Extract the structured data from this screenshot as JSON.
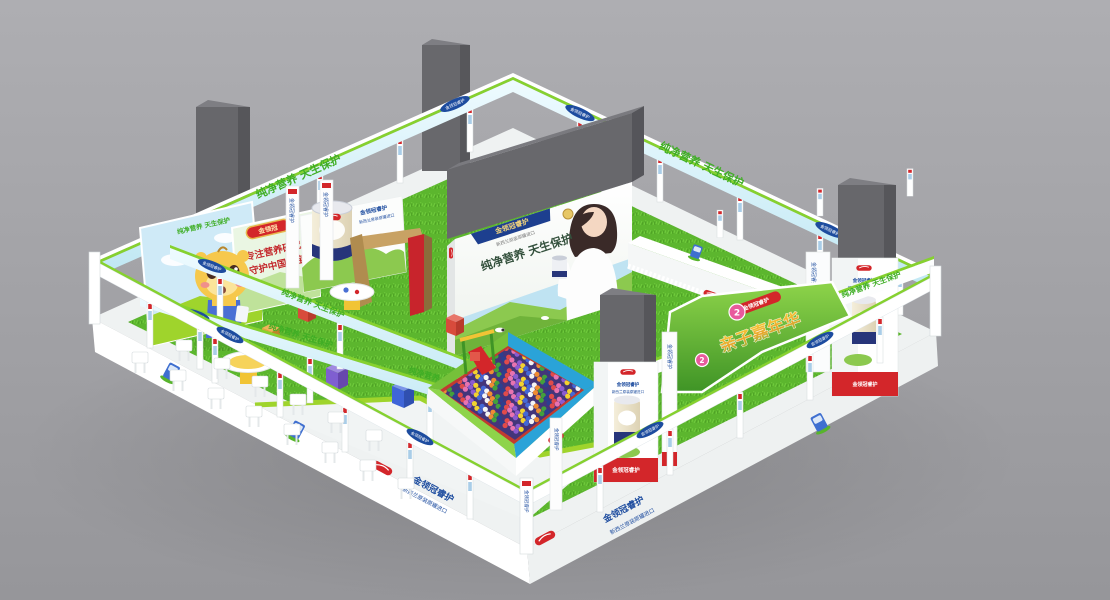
{
  "scene": {
    "background_top": "#aeaeb2",
    "background_bottom": "#96969a"
  },
  "texts": {
    "slogan": "纯净营养 天生保护",
    "brand": "金领冠",
    "badge": "金领冠睿护",
    "badge_sub": "新西兰原装原罐进口",
    "carnival": "亲子嘉年华",
    "signboard_line1": "专注营养研究",
    "signboard_line2": "守护中国宝宝",
    "marker_2": "2"
  },
  "colors": {
    "grass": "#5cb62e",
    "banner_green": "#3fae25",
    "badge_blue": "#1d4c9f",
    "brand_red": "#d3262a",
    "pillar_gray": "#67676b",
    "arch_gold": "#c8a264",
    "marker_pink": "#e85a9c",
    "pit_rim_blue": "#2aa3d8",
    "pit_rim_green": "#76c13a",
    "pit_lining_red": "#c23a30"
  },
  "ball_pit": {
    "colors": [
      "#e14b4b",
      "#4468d6",
      "#2c3f8f",
      "#f3d230",
      "#43a13c",
      "#8c5bd0",
      "#ef8c33",
      "#e873b0",
      "#f5f5f5"
    ]
  }
}
